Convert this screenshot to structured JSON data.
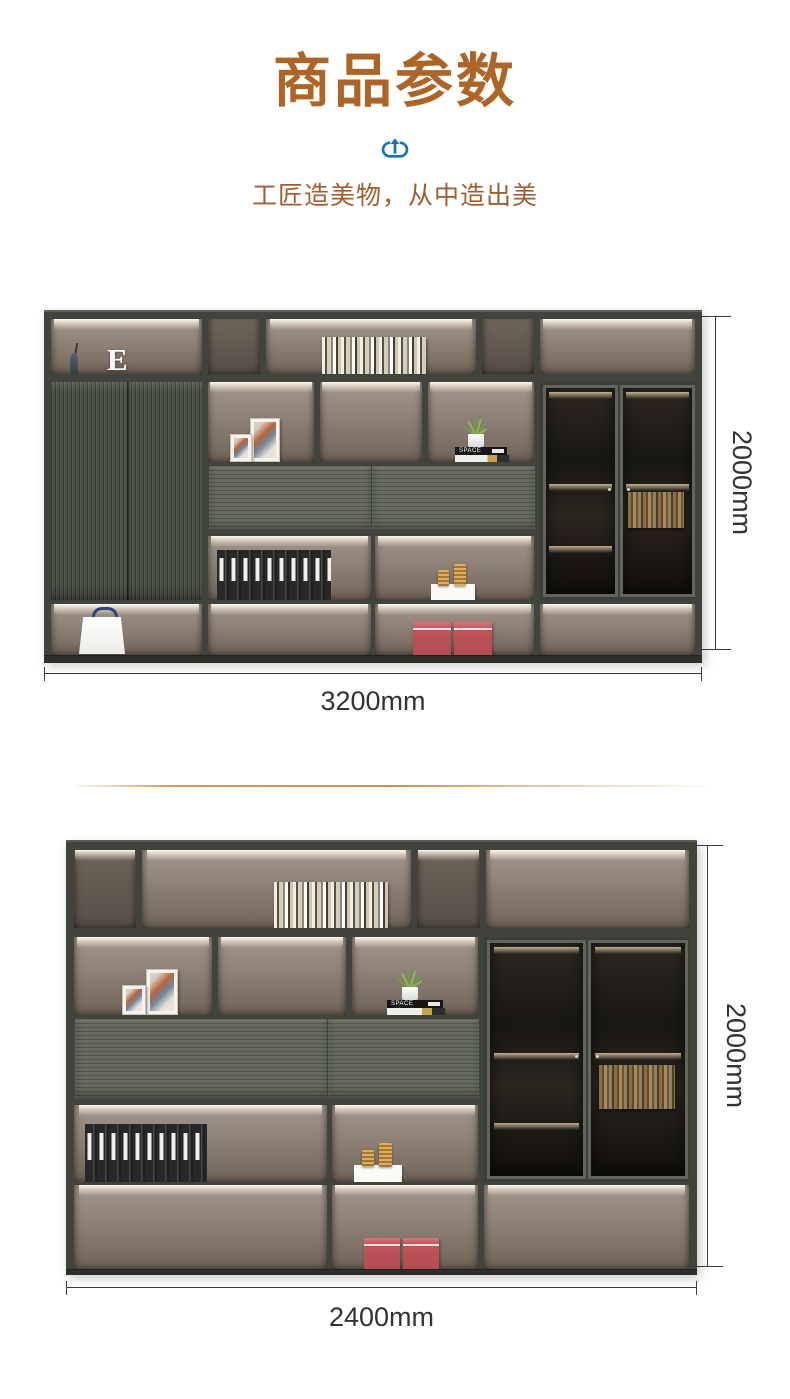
{
  "header": {
    "title": "商品参数",
    "icon": "upload-icon",
    "subtitle": "工匠造美物，从中造出美"
  },
  "products": [
    {
      "name": "wall-bookcase-3200",
      "width_label": "3200mm",
      "height_label": "2000mm",
      "decor_letter": "E",
      "book_spine_text": "SPACE"
    },
    {
      "name": "wall-bookcase-2400",
      "width_label": "2400mm",
      "height_label": "2000mm",
      "book_spine_text": "SPACE"
    }
  ],
  "colors": {
    "title": "#ae6424",
    "subtitle": "#a15e30",
    "icon_blue": "#1a71b2",
    "dimension_text": "#333333",
    "divider_accent": "#d79a58"
  }
}
